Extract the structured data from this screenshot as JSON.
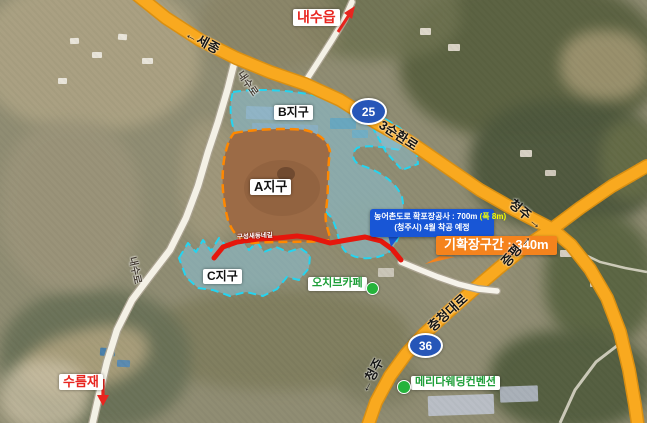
{
  "map": {
    "destinations": {
      "naesu_eup": "내수읍",
      "sejong": "←세종",
      "cheongju_ne": "청주",
      "cheongju_ne_arrow": "→",
      "jeungpyeong": "증평",
      "jeungpyeong_arrow": "→",
      "cheongju_sw": "←청주",
      "sureumjae": "수름재"
    },
    "road_names": {
      "naesu_ro": "내수로",
      "samsunhwan_ro": "3순환로",
      "chungcheong_daero": "충청대로",
      "saedongne_gil": "구성새동네길"
    },
    "route_badges": [
      {
        "number": "25"
      },
      {
        "number": "36"
      }
    ],
    "zones": [
      {
        "label": "A지구"
      },
      {
        "label": "B지구"
      },
      {
        "label": "C지구"
      }
    ],
    "pois": {
      "ochiv_cafe": "오치브카페",
      "merida": "메리다웨딩컨벤션"
    },
    "callouts": {
      "construction": {
        "line1": "농어촌도로 확포장공사 : 700m",
        "line1_note": "(폭 8m)",
        "line2": "(청주시) 4월 착공 예정"
      },
      "widened": "기확장구간 : 340m"
    },
    "colors": {
      "highway_orange": "#f9a91f",
      "construction_red": "#e6160c",
      "zone_border_cyan": "#25d4f0",
      "zone_border_orange": "#ff8800",
      "callout_blue": "#1856d6",
      "callout_orange": "#f5831d",
      "route_badge_blue": "#2656b8",
      "poi_green": "#1e9e38",
      "destination_red": "#e8251f"
    }
  }
}
